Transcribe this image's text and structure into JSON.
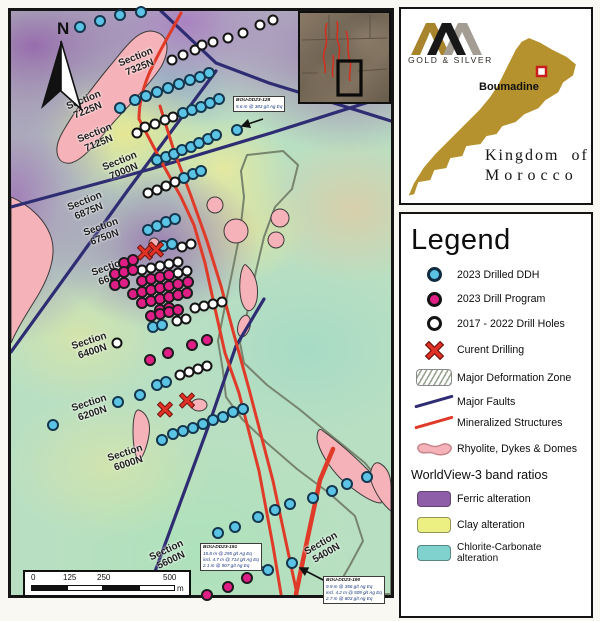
{
  "branding": {
    "logo_sub": "GOLD & SILVER",
    "site_label": "Boumadine",
    "country_line1": "Kingdom of",
    "country_line2": "Morocco"
  },
  "legend": {
    "title": "Legend",
    "items": [
      {
        "icon": "ddh-2023-icon",
        "label": "2023 Drilled DDH"
      },
      {
        "icon": "program-2023-icon",
        "label": "2023 Drill Program"
      },
      {
        "icon": "holes-2017-2022-icon",
        "label": "2017 - 2022 Drill Holes"
      },
      {
        "icon": "current-drilling-icon",
        "label": "Curent Drilling"
      },
      {
        "icon": "deformation-zone-icon",
        "label": "Major Deformation Zone"
      },
      {
        "icon": "major-faults-icon",
        "label": "Major Faults"
      },
      {
        "icon": "mineralized-structures-icon",
        "label": "Mineralized Structures"
      },
      {
        "icon": "rhyolite-icon",
        "label": "Rhyolite, Dykes & Domes"
      }
    ],
    "band_ratios_title": "WorldView-3 band ratios",
    "band_ratios": [
      {
        "color": "#8e5fa8",
        "label": "Ferric alteration"
      },
      {
        "color": "#ecef82",
        "label": "Clay alteration"
      },
      {
        "color": "#7fd2cd",
        "label": "Chlorite-Carbonate alteration"
      }
    ]
  },
  "map": {
    "north_label": "N",
    "scalebar": {
      "ticks": [
        "0",
        "125",
        "250",
        "500"
      ],
      "unit": "m"
    },
    "sections": [
      {
        "line1": "Section",
        "line2": "7325N",
        "x": 127,
        "y": 52,
        "r": -22
      },
      {
        "line1": "Section",
        "line2": "7225N",
        "x": 75,
        "y": 95,
        "r": -22
      },
      {
        "line1": "Section",
        "line2": "7125N",
        "x": 86,
        "y": 128,
        "r": -22
      },
      {
        "line1": "Section",
        "line2": "7000N",
        "x": 111,
        "y": 156,
        "r": -22
      },
      {
        "line1": "Section",
        "line2": "6875N",
        "x": 76,
        "y": 196,
        "r": -22
      },
      {
        "line1": "Section",
        "line2": "6750N",
        "x": 92,
        "y": 222,
        "r": -20
      },
      {
        "line1": "Section",
        "line2": "6625N",
        "x": 100,
        "y": 262,
        "r": -20
      },
      {
        "line1": "Section",
        "line2": "6400N",
        "x": 80,
        "y": 336,
        "r": -18
      },
      {
        "line1": "Section",
        "line2": "6200N",
        "x": 80,
        "y": 398,
        "r": -18
      },
      {
        "line1": "Section",
        "line2": "6000N",
        "x": 116,
        "y": 448,
        "r": -18
      },
      {
        "line1": "Section",
        "line2": "5600N",
        "x": 158,
        "y": 545,
        "r": -25
      },
      {
        "line1": "Section",
        "line2": "5400N",
        "x": 313,
        "y": 538,
        "r": -30
      }
    ],
    "annotations": [
      {
        "id": "BOU-DD23-128",
        "lines": [
          "5.6 m @ 383 g/t Ag Eq"
        ],
        "x": 222,
        "y": 85
      },
      {
        "id": "BOU-DD23-191",
        "lines": [
          "15.8 m @ 295 g/t Ag Eq",
          "incl. 4.7 m @ 714 g/t Ag Eq",
          "2.1 m @ 907 g/t Ag Eq"
        ],
        "x": 189,
        "y": 532
      },
      {
        "id": "BOU-DD23-190",
        "lines": [
          "9.9 m @ 356 g/t Ag Eq",
          "incl. 4.2 m @ 509 g/t Ag Eq",
          "2.7 m @ 803 g/t Ag Eq"
        ],
        "x": 312,
        "y": 565
      }
    ],
    "drill_holes": {
      "ddh_2023": [
        [
          69,
          16
        ],
        [
          89,
          10
        ],
        [
          109,
          4
        ],
        [
          130,
          1
        ],
        [
          109,
          97
        ],
        [
          124,
          89
        ],
        [
          135,
          85
        ],
        [
          146,
          81
        ],
        [
          157,
          77
        ],
        [
          168,
          73
        ],
        [
          179,
          69
        ],
        [
          189,
          66
        ],
        [
          198,
          62
        ],
        [
          172,
          102
        ],
        [
          181,
          99
        ],
        [
          190,
          96
        ],
        [
          199,
          92
        ],
        [
          208,
          88
        ],
        [
          226,
          119
        ],
        [
          146,
          149
        ],
        [
          155,
          146
        ],
        [
          163,
          143
        ],
        [
          171,
          139
        ],
        [
          180,
          136
        ],
        [
          188,
          132
        ],
        [
          197,
          128
        ],
        [
          205,
          124
        ],
        [
          173,
          167
        ],
        [
          182,
          163
        ],
        [
          190,
          160
        ],
        [
          137,
          219
        ],
        [
          146,
          215
        ],
        [
          155,
          211
        ],
        [
          164,
          208
        ],
        [
          152,
          235
        ],
        [
          161,
          233
        ],
        [
          142,
          316
        ],
        [
          151,
          314
        ],
        [
          146,
          374
        ],
        [
          155,
          371
        ],
        [
          42,
          414
        ],
        [
          107,
          391
        ],
        [
          129,
          384
        ],
        [
          151,
          429
        ],
        [
          162,
          423
        ],
        [
          172,
          420
        ],
        [
          182,
          417
        ],
        [
          192,
          413
        ],
        [
          202,
          409
        ],
        [
          212,
          406
        ],
        [
          222,
          401
        ],
        [
          232,
          398
        ],
        [
          207,
          522
        ],
        [
          224,
          516
        ],
        [
          247,
          506
        ],
        [
          264,
          499
        ],
        [
          279,
          493
        ],
        [
          302,
          487
        ],
        [
          321,
          480
        ],
        [
          336,
          473
        ],
        [
          356,
          466
        ],
        [
          257,
          559
        ],
        [
          281,
          552
        ]
      ],
      "program_2023": [
        [
          113,
          252
        ],
        [
          122,
          249
        ],
        [
          104,
          263
        ],
        [
          113,
          261
        ],
        [
          122,
          259
        ],
        [
          104,
          274
        ],
        [
          113,
          272
        ],
        [
          131,
          270
        ],
        [
          140,
          268
        ],
        [
          149,
          266
        ],
        [
          158,
          264
        ],
        [
          122,
          283
        ],
        [
          131,
          281
        ],
        [
          140,
          279
        ],
        [
          149,
          277
        ],
        [
          158,
          275
        ],
        [
          167,
          273
        ],
        [
          177,
          271
        ],
        [
          131,
          292
        ],
        [
          140,
          290
        ],
        [
          149,
          288
        ],
        [
          158,
          286
        ],
        [
          167,
          284
        ],
        [
          176,
          282
        ],
        [
          149,
          299
        ],
        [
          158,
          297
        ],
        [
          140,
          305
        ],
        [
          149,
          303
        ],
        [
          158,
          301
        ],
        [
          167,
          299
        ],
        [
          196,
          329
        ],
        [
          139,
          349
        ],
        [
          157,
          342
        ],
        [
          181,
          334
        ],
        [
          196,
          584
        ],
        [
          217,
          576
        ],
        [
          236,
          567
        ]
      ],
      "holes_2017_2022": [
        [
          161,
          49
        ],
        [
          172,
          44
        ],
        [
          184,
          39
        ],
        [
          191,
          34
        ],
        [
          202,
          31
        ],
        [
          217,
          27
        ],
        [
          232,
          22
        ],
        [
          249,
          14
        ],
        [
          262,
          9
        ],
        [
          126,
          122
        ],
        [
          134,
          116
        ],
        [
          144,
          113
        ],
        [
          154,
          109
        ],
        [
          162,
          106
        ],
        [
          137,
          182
        ],
        [
          146,
          179
        ],
        [
          155,
          175
        ],
        [
          164,
          171
        ],
        [
          171,
          236
        ],
        [
          180,
          233
        ],
        [
          131,
          259
        ],
        [
          140,
          257
        ],
        [
          149,
          255
        ],
        [
          158,
          253
        ],
        [
          167,
          251
        ],
        [
          167,
          262
        ],
        [
          176,
          260
        ],
        [
          184,
          297
        ],
        [
          193,
          295
        ],
        [
          202,
          293
        ],
        [
          211,
          291
        ],
        [
          166,
          310
        ],
        [
          175,
          308
        ],
        [
          106,
          332
        ],
        [
          169,
          364
        ],
        [
          178,
          361
        ],
        [
          187,
          358
        ],
        [
          196,
          355
        ]
      ],
      "current_drilling": [
        [
          134,
          244
        ],
        [
          145,
          241
        ],
        [
          154,
          401
        ],
        [
          176,
          392
        ]
      ]
    },
    "colors": {
      "ddh_2023": "#5bc4e4",
      "program_2023": "#e01f86",
      "holes_2017_2022": "#ffffff",
      "current_drilling": "#e03127",
      "major_fault": "#2e2c72",
      "mineralized_structure": "#e03a28",
      "rhyolite": "#f5b2b8"
    }
  }
}
